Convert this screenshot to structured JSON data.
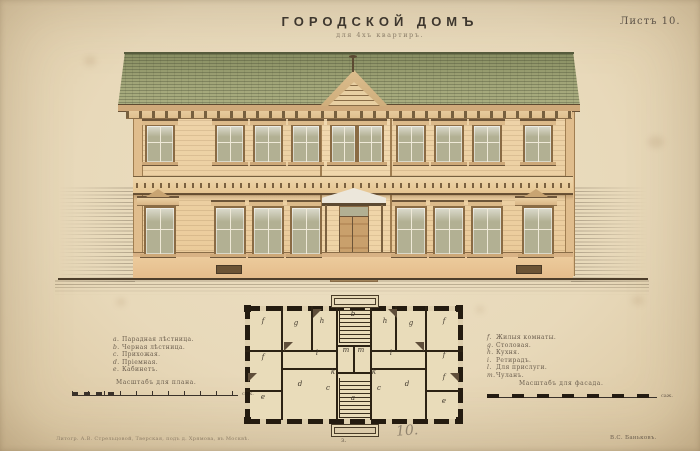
{
  "page": {
    "title": "ГОРОДСКОЙ ДОМЪ",
    "subtitle": "для 4хъ квартиръ.",
    "sheet_label": "Листъ 10."
  },
  "legend_left": {
    "items": [
      {
        "key": "a.",
        "text": "Парадная лѣстница."
      },
      {
        "key": "b.",
        "text": "Черная лѣстница."
      },
      {
        "key": "c.",
        "text": "Прихожая."
      },
      {
        "key": "d.",
        "text": "Пріемная."
      },
      {
        "key": "e.",
        "text": "Кабинетъ."
      }
    ]
  },
  "legend_right": {
    "items": [
      {
        "key": "f.",
        "text": "Жилыя комнаты."
      },
      {
        "key": "g.",
        "text": "Столовая."
      },
      {
        "key": "h.",
        "text": "Кухня."
      },
      {
        "key": "i.",
        "text": "Ретирадъ."
      },
      {
        "key": "l.",
        "text": "Для прислуги."
      },
      {
        "key": "m.",
        "text": "Чуланъ."
      }
    ]
  },
  "scales": {
    "plan_label": "Масштабъ для плана.",
    "facade_label": "Масштабъ для фасада.",
    "unit": "саж."
  },
  "plan": {
    "labels": [
      {
        "t": "f",
        "x": 263,
        "y": 321
      },
      {
        "t": "g",
        "x": 296,
        "y": 323
      },
      {
        "t": "h",
        "x": 322,
        "y": 321
      },
      {
        "t": "b",
        "x": 353,
        "y": 314
      },
      {
        "t": "h",
        "x": 385,
        "y": 321
      },
      {
        "t": "g",
        "x": 411,
        "y": 323
      },
      {
        "t": "f",
        "x": 444,
        "y": 321
      },
      {
        "t": "f",
        "x": 263,
        "y": 357
      },
      {
        "t": "l",
        "x": 317,
        "y": 353
      },
      {
        "t": "m",
        "x": 346,
        "y": 350
      },
      {
        "t": "m",
        "x": 361,
        "y": 350
      },
      {
        "t": "l",
        "x": 391,
        "y": 353
      },
      {
        "t": "f",
        "x": 444,
        "y": 355
      },
      {
        "t": "k",
        "x": 333,
        "y": 372
      },
      {
        "t": "k",
        "x": 374,
        "y": 372
      },
      {
        "t": "f",
        "x": 444,
        "y": 377
      },
      {
        "t": "e",
        "x": 263,
        "y": 397
      },
      {
        "t": "d",
        "x": 300,
        "y": 384
      },
      {
        "t": "c",
        "x": 328,
        "y": 388
      },
      {
        "t": "a",
        "x": 353,
        "y": 398
      },
      {
        "t": "c",
        "x": 379,
        "y": 388
      },
      {
        "t": "d",
        "x": 407,
        "y": 384
      },
      {
        "t": "e",
        "x": 444,
        "y": 401
      }
    ],
    "plate_mark": "з."
  },
  "footer": {
    "imprint": "Литогр. А.В. Стрельцовой, Тверская, подъ д. Хрямова, въ Москвѣ.",
    "signature": "В.С. Баньковъ.",
    "handwritten_number": "10."
  },
  "colors": {
    "paper": "#e8d9ba",
    "facade": "#eed2a6",
    "roof": "#9ba277",
    "plan_wall": "#241b10",
    "ink": "#3e372e"
  }
}
